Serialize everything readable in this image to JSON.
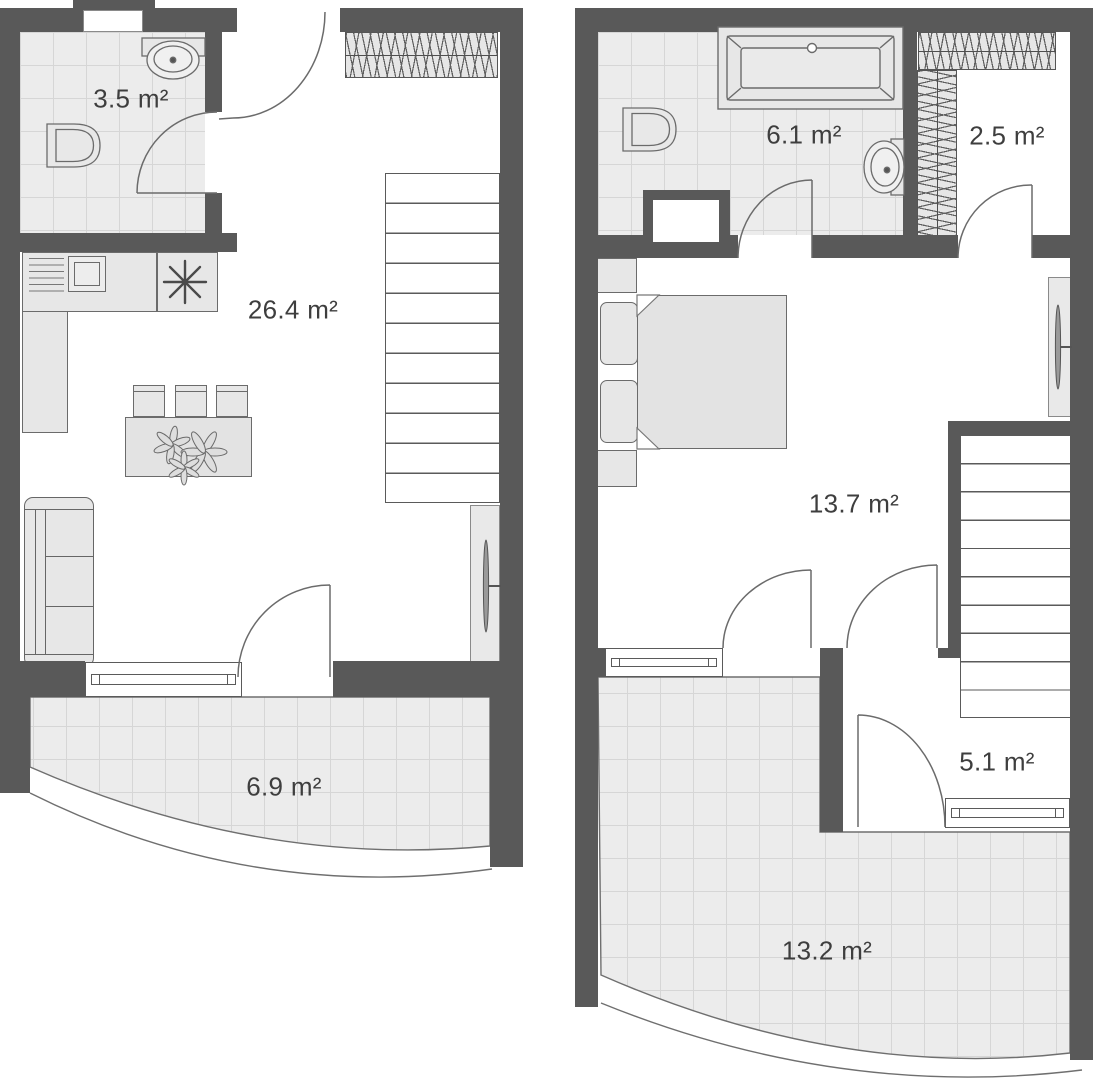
{
  "floor1": {
    "bathroom_area": "3.5 m²",
    "living_kitchen_area": "26.4 m²",
    "balcony_area": "6.9 m²"
  },
  "floor2": {
    "bathroom_area": "6.1 m²",
    "wardrobe_area": "2.5 m²",
    "bedroom_area": "13.7 m²",
    "hall_area": "5.1 m²",
    "terrace_area": "13.2 m²"
  },
  "colors": {
    "wall": "#595959",
    "tile_fill": "#ececec",
    "tile_grid": "#d6d6d6",
    "furniture_fill": "#e7e7e7",
    "outline": "#6b6b6b",
    "label_text": "#3e3e3e",
    "background": "#ffffff"
  },
  "icons": [
    "toilet-icon",
    "sink-icon",
    "bathtub-icon",
    "stove-icon",
    "plant-icon",
    "radiator-icon",
    "sofa",
    "bed",
    "dining-table",
    "chair",
    "wardrobe",
    "stairs",
    "window",
    "door-swing",
    "balcony-railing",
    "ventilation-shaft"
  ]
}
